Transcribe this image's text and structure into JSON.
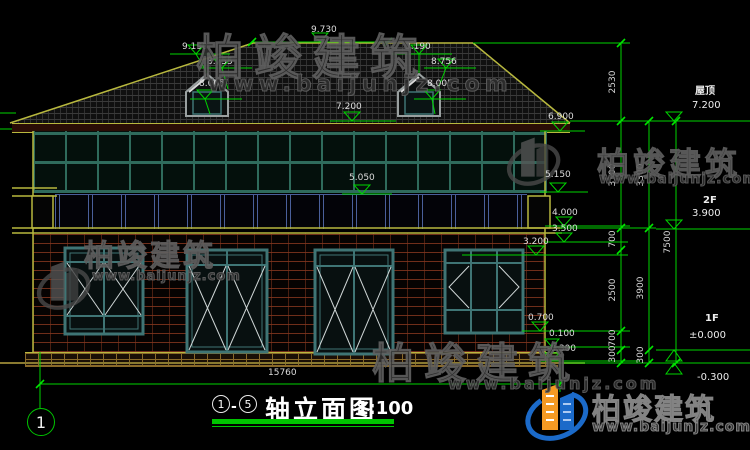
{
  "watermark": {
    "cn": "柏竣建筑",
    "url": "www.baijunjz.com"
  },
  "marks": {
    "ridge": "9.730",
    "dormer_l_top": "9.190",
    "dormer_l_eave": "8.755",
    "dormer_l_base": "8.005",
    "dormer_r_top": "9.190",
    "dormer_r_eave": "8.756",
    "dormer_r_base": "8.005",
    "roof_deck": "7.200",
    "eave_right": "6.900",
    "rail_mid": "5.050",
    "rail_right": "5.150",
    "slab_top": "4.000",
    "slab_bottom": "3.500",
    "opening_top": "3.200",
    "sill": "0.700",
    "plinth": "0.100",
    "ground": "-0.300",
    "total_width": "15760"
  },
  "levels": {
    "roof_label": "屋顶",
    "roof_value": "7.200",
    "f2_label": "2F",
    "f2_value": "3.900",
    "f1_label": "1F",
    "f1_value": "±0.000",
    "ground_value": "-0.300"
  },
  "chains": {
    "c1": [
      "2530",
      "3300",
      "700",
      "2500",
      "700",
      "300"
    ],
    "c2": [
      "3300",
      "3900",
      "300"
    ],
    "c3": [
      "7500"
    ]
  },
  "title_block": {
    "axis_start": "1",
    "axis_sep": "-",
    "axis_end": "5",
    "title": "轴立面图",
    "scale": "1:100"
  },
  "axis": {
    "bubble": "1"
  },
  "colors": {
    "dim_green": "#00d400",
    "accent_yellow": "#b8b83e",
    "frame_teal": "#3f7575",
    "railing_blue": "#4a5f9a",
    "brick_red": "#82361e",
    "logo_blue": "#1b6ac9",
    "logo_orange": "#f59a23"
  }
}
